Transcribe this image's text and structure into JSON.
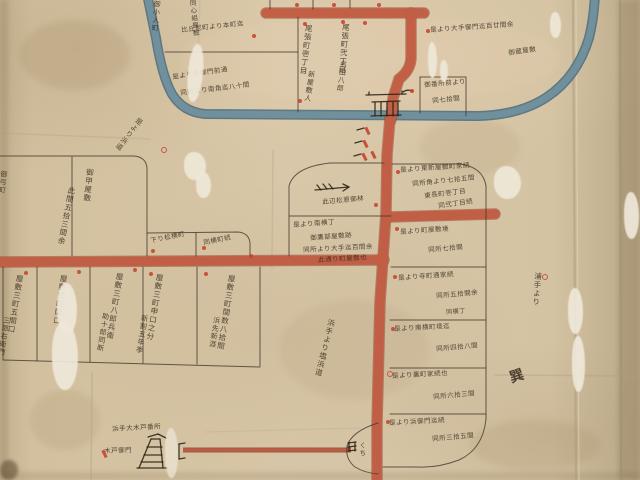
{
  "map": {
    "palette": {
      "paper": "#d5c4a4",
      "moat_water": "#71909d",
      "road": "#c25e45",
      "ink": "#392c1e",
      "marker_red": "#c7422e"
    },
    "labels": [
      {
        "text": "御小人町",
        "x": 153,
        "y": 0,
        "mode": "v",
        "rot": 4,
        "size": 7
      },
      {
        "text": "同心組屋敷",
        "x": 188,
        "y": 0,
        "mode": "v",
        "rot": -6,
        "size": 6.5
      },
      {
        "text": "比丘尼町より本町迄",
        "x": 181,
        "y": 27,
        "mode": "h",
        "rot": -6,
        "size": 6.5
      },
      {
        "text": "是より西御門前通",
        "x": 172,
        "y": 74,
        "mode": "h",
        "rot": -8,
        "size": 6.5
      },
      {
        "text": "同所より南角迄八十間",
        "x": 180,
        "y": 90,
        "mode": "h",
        "rot": -7,
        "size": 6.5
      },
      {
        "text": "尾張町壱丁目",
        "x": 305,
        "y": 24,
        "mode": "v",
        "rot": 7,
        "size": 7.5
      },
      {
        "text": "新屋敷人",
        "x": 308,
        "y": 70,
        "mode": "v",
        "rot": 9,
        "size": 7
      },
      {
        "text": "尾張町弐丁目",
        "x": 342,
        "y": 23,
        "mode": "v",
        "rot": 5,
        "size": 7.5
      },
      {
        "text": "名田八郎",
        "x": 340,
        "y": 60,
        "mode": "v",
        "rot": 8,
        "size": 7
      },
      {
        "text": "是より大手御門迄百廿間余",
        "x": 430,
        "y": 27,
        "mode": "h",
        "rot": -4,
        "size": 6.5
      },
      {
        "text": "御蔵屋敷",
        "x": 508,
        "y": 50,
        "mode": "h",
        "rot": -8,
        "size": 6.5
      },
      {
        "text": "御番所前より",
        "x": 424,
        "y": 82,
        "mode": "h",
        "rot": -5,
        "size": 6.5
      },
      {
        "text": "同七拾間",
        "x": 432,
        "y": 98,
        "mode": "h",
        "rot": -6,
        "size": 6.5
      },
      {
        "text": "是より浜道",
        "x": 138,
        "y": 116,
        "mode": "v",
        "rot": 38,
        "size": 7
      },
      {
        "text": "御弓町",
        "x": 0,
        "y": 170,
        "mode": "v",
        "rot": 6,
        "size": 7
      },
      {
        "text": "御甲屋敷",
        "x": 86,
        "y": 168,
        "mode": "v",
        "rot": 6,
        "size": 7.5
      },
      {
        "text": "此間五拾三間余",
        "x": 68,
        "y": 186,
        "mode": "v",
        "rot": 11,
        "size": 7.5
      },
      {
        "text": "下り松横町",
        "x": 150,
        "y": 238,
        "mode": "h",
        "rot": -12,
        "size": 6.5
      },
      {
        "text": "同横町続",
        "x": 203,
        "y": 240,
        "mode": "h",
        "rot": -12,
        "size": 6.5
      },
      {
        "text": "此辺松原御林",
        "x": 322,
        "y": 199,
        "mode": "h",
        "rot": -5,
        "size": 6.5
      },
      {
        "text": "是より南横丁",
        "x": 293,
        "y": 222,
        "mode": "h",
        "rot": -4,
        "size": 6.5
      },
      {
        "text": "御鷹部屋敷跡",
        "x": 310,
        "y": 235,
        "mode": "h",
        "rot": -4,
        "size": 6.5
      },
      {
        "text": "同所より大手迄百間余",
        "x": 303,
        "y": 247,
        "mode": "h",
        "rot": -3,
        "size": 6.5
      },
      {
        "text": "此通り町屋敷也",
        "x": 318,
        "y": 257,
        "mode": "h",
        "rot": -3,
        "size": 6.5
      },
      {
        "text": "是より東新屋敷町家続",
        "x": 400,
        "y": 167,
        "mode": "h",
        "rot": -4,
        "size": 6.5
      },
      {
        "text": "同所角より七拾五間",
        "x": 412,
        "y": 181,
        "mode": "h",
        "rot": -6,
        "size": 6.5
      },
      {
        "text": "東長町壱丁目",
        "x": 424,
        "y": 193,
        "mode": "h",
        "rot": -7,
        "size": 6.5
      },
      {
        "text": "同弐丁目続",
        "x": 438,
        "y": 203,
        "mode": "h",
        "rot": -8,
        "size": 6.5
      },
      {
        "text": "是より町屋敷境",
        "x": 400,
        "y": 229,
        "mode": "h",
        "rot": -4,
        "size": 6.5
      },
      {
        "text": "同所七拾間",
        "x": 428,
        "y": 247,
        "mode": "h",
        "rot": -5,
        "size": 6.5
      },
      {
        "text": "是より寺町通家続",
        "x": 398,
        "y": 275,
        "mode": "h",
        "rot": -4,
        "size": 6.5
      },
      {
        "text": "同所五拾間余",
        "x": 436,
        "y": 293,
        "mode": "h",
        "rot": -5,
        "size": 6.5
      },
      {
        "text": "同横丁",
        "x": 446,
        "y": 310,
        "mode": "h",
        "rot": -4,
        "size": 6
      },
      {
        "text": "是より南横町境迄",
        "x": 394,
        "y": 326,
        "mode": "h",
        "rot": -3,
        "size": 6.5
      },
      {
        "text": "同所四拾八間",
        "x": 436,
        "y": 346,
        "mode": "h",
        "rot": -5,
        "size": 6.5
      },
      {
        "text": "是より裏町家続也",
        "x": 392,
        "y": 373,
        "mode": "h",
        "rot": -3,
        "size": 6.5
      },
      {
        "text": "同所六拾三間",
        "x": 433,
        "y": 394,
        "mode": "h",
        "rot": -5,
        "size": 6.5
      },
      {
        "text": "是より浜御門迄続",
        "x": 389,
        "y": 420,
        "mode": "h",
        "rot": -3,
        "size": 6.5
      },
      {
        "text": "同所三拾五間",
        "x": 432,
        "y": 436,
        "mode": "h",
        "rot": -5,
        "size": 6.5
      },
      {
        "text": "屋敷三町五間口",
        "x": 16,
        "y": 274,
        "mode": "v",
        "rot": 9,
        "size": 7.5
      },
      {
        "text": "三郎右衛門",
        "x": 3,
        "y": 316,
        "mode": "v",
        "rot": 9,
        "size": 7
      },
      {
        "text": "屋敷弐町間口",
        "x": 60,
        "y": 274,
        "mode": "v",
        "rot": 9,
        "size": 7.5
      },
      {
        "text": "屋敷三町八郎兵衛",
        "x": 116,
        "y": 272,
        "mode": "v",
        "rot": 9,
        "size": 7.5
      },
      {
        "text": "助十郎同断",
        "x": 102,
        "y": 312,
        "mode": "v",
        "rot": 9,
        "size": 7
      },
      {
        "text": "屋敷三町申口之分",
        "x": 156,
        "y": 273,
        "mode": "v",
        "rot": 9,
        "size": 7.5
      },
      {
        "text": "新割五年季",
        "x": 141,
        "y": 314,
        "mode": "v",
        "rot": 9,
        "size": 7
      },
      {
        "text": "屋敷三町間数八拾間",
        "x": 228,
        "y": 274,
        "mode": "v",
        "rot": 9,
        "size": 7.5
      },
      {
        "text": "浜先新涯",
        "x": 213,
        "y": 316,
        "mode": "v",
        "rot": 9,
        "size": 7
      },
      {
        "text": "浜手より塩浜道",
        "x": 328,
        "y": 318,
        "mode": "v",
        "rot": 14,
        "size": 7.5
      },
      {
        "text": "浦手より",
        "x": 534,
        "y": 272,
        "mode": "v",
        "rot": 4,
        "size": 7.5
      },
      {
        "text": "巽",
        "x": 508,
        "y": 372,
        "mode": "h",
        "rot": -18,
        "size": 14,
        "weight": 700
      },
      {
        "text": "浜手大木戸番所",
        "x": 112,
        "y": 426,
        "mode": "h",
        "rot": -3,
        "size": 6.5
      },
      {
        "text": "木戸御門",
        "x": 104,
        "y": 448,
        "mode": "h",
        "rot": -2,
        "size": 6.5
      },
      {
        "text": "くち",
        "x": 358,
        "y": 442,
        "mode": "v",
        "rot": 0,
        "size": 6.5
      }
    ],
    "marks": [
      {
        "x": 295,
        "y": 3,
        "kind": "dot"
      },
      {
        "x": 332,
        "y": 3,
        "kind": "dot"
      },
      {
        "x": 363,
        "y": 21,
        "kind": "dot"
      },
      {
        "x": 377,
        "y": 3,
        "kind": "dot"
      },
      {
        "x": 252,
        "y": 34,
        "kind": "dot"
      },
      {
        "x": 298,
        "y": 99,
        "kind": "dot"
      },
      {
        "x": 303,
        "y": 22,
        "kind": "dot"
      },
      {
        "x": 341,
        "y": 20,
        "kind": "dot"
      },
      {
        "x": 426,
        "y": 29,
        "kind": "dot"
      },
      {
        "x": 410,
        "y": 89,
        "kind": "dot"
      },
      {
        "x": 161,
        "y": 147,
        "kind": "ring"
      },
      {
        "x": 151,
        "y": 249,
        "kind": "dot"
      },
      {
        "x": 202,
        "y": 246,
        "kind": "dot"
      },
      {
        "x": 249,
        "y": 254,
        "kind": "dot"
      },
      {
        "x": 374,
        "y": 203,
        "kind": "dot"
      },
      {
        "x": 372,
        "y": 151,
        "kind": "banner"
      },
      {
        "x": 396,
        "y": 170,
        "kind": "dot"
      },
      {
        "x": 395,
        "y": 227,
        "kind": "dot"
      },
      {
        "x": 393,
        "y": 275,
        "kind": "dot"
      },
      {
        "x": 391,
        "y": 327,
        "kind": "dot"
      },
      {
        "x": 387,
        "y": 371,
        "kind": "ring"
      },
      {
        "x": 386,
        "y": 420,
        "kind": "dot"
      },
      {
        "x": 24,
        "y": 271,
        "kind": "dot"
      },
      {
        "x": 77,
        "y": 270,
        "kind": "dot"
      },
      {
        "x": 133,
        "y": 268,
        "kind": "dot"
      },
      {
        "x": 149,
        "y": 272,
        "kind": "dot"
      },
      {
        "x": 204,
        "y": 272,
        "kind": "dot"
      },
      {
        "x": 542,
        "y": 274,
        "kind": "ring"
      },
      {
        "x": 366,
        "y": 127,
        "kind": "banner"
      },
      {
        "x": 364,
        "y": 140,
        "kind": "banner"
      },
      {
        "x": 363,
        "y": 153,
        "kind": "banner"
      },
      {
        "x": 103,
        "y": 450,
        "kind": "banner"
      }
    ]
  }
}
